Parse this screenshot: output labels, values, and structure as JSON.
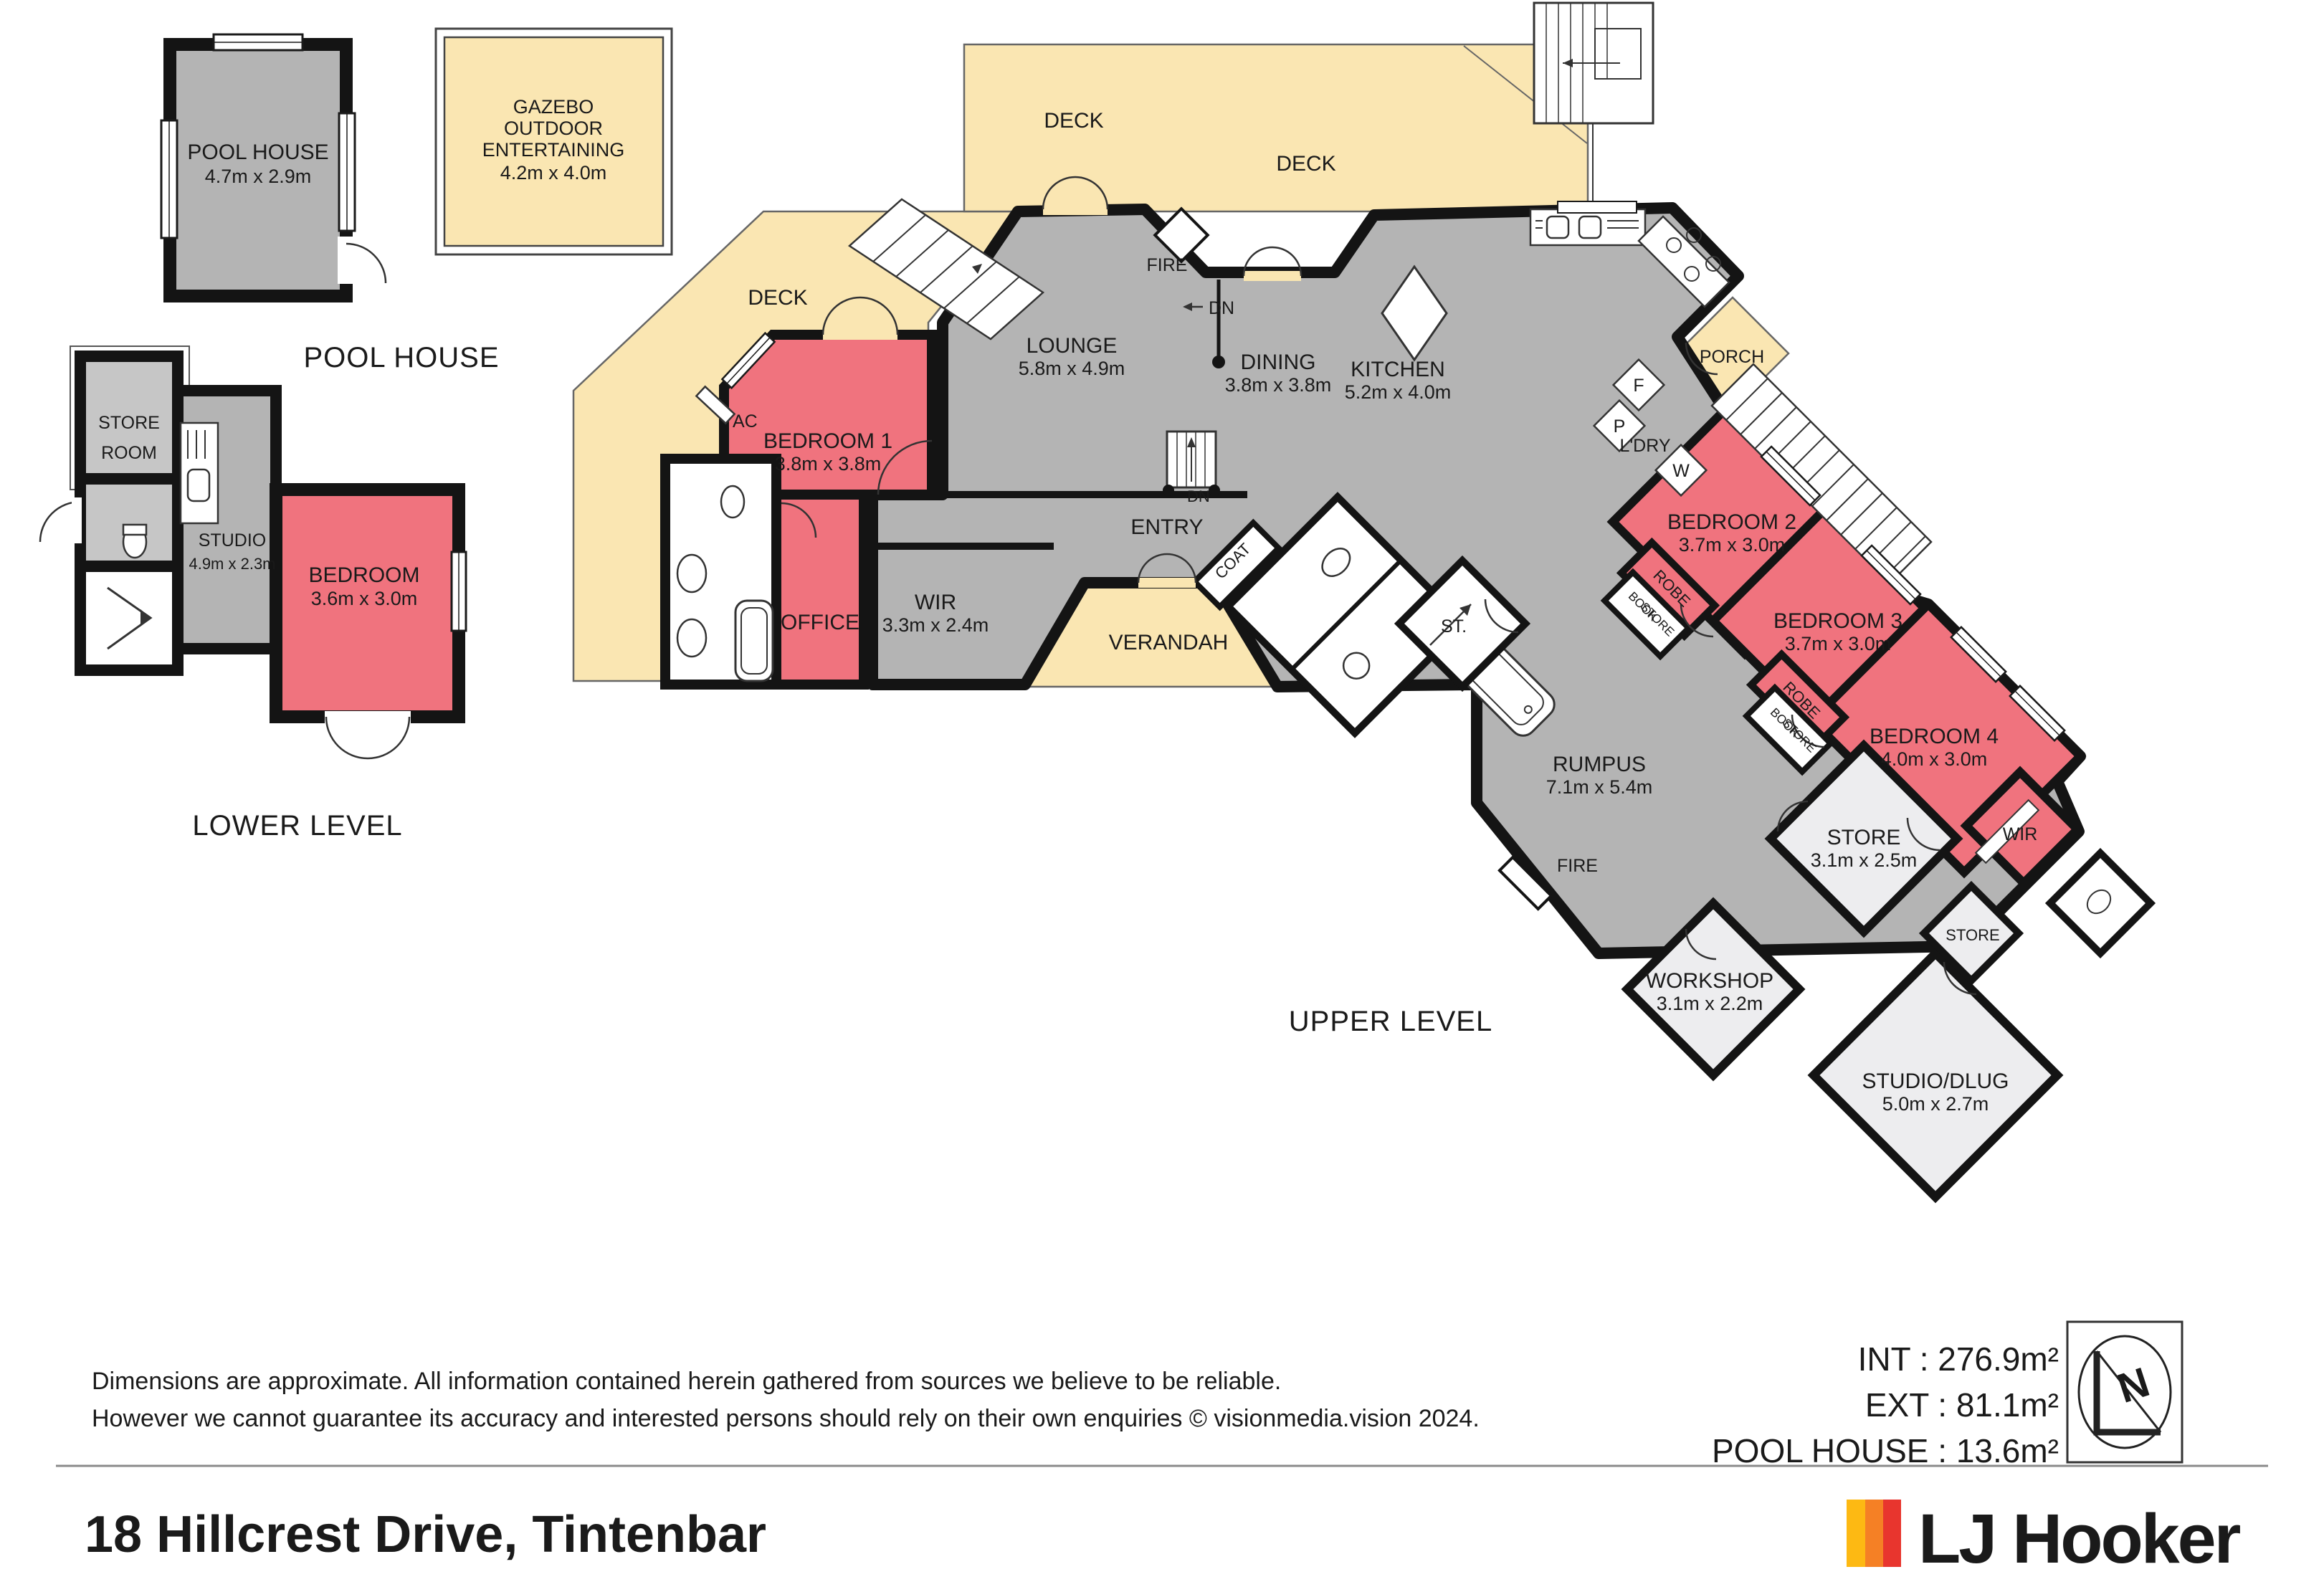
{
  "headings": {
    "pool_house": "POOL HOUSE",
    "lower_level": "LOWER LEVEL",
    "upper_level": "UPPER LEVEL"
  },
  "rooms": {
    "pool_house": {
      "name": "POOL HOUSE",
      "dims": "4.7m x 2.9m"
    },
    "gazebo": {
      "line1": "GAZEBO",
      "line2": "OUTDOOR",
      "line3": "ENTERTAINING",
      "dims": "4.2m x 4.0m"
    },
    "store_room": {
      "line1": "STORE",
      "line2": "ROOM"
    },
    "studio": {
      "name": "STUDIO",
      "dims": "4.9m x 2.3m"
    },
    "bedroom_lower": {
      "name": "BEDROOM",
      "dims": "3.6m x 3.0m"
    },
    "lounge": {
      "name": "LOUNGE",
      "dims": "5.8m x 4.9m"
    },
    "dining": {
      "name": "DINING",
      "dims": "3.8m x 3.8m"
    },
    "kitchen": {
      "name": "KITCHEN",
      "dims": "5.2m x 4.0m"
    },
    "bedroom1": {
      "name": "BEDROOM 1",
      "dims": "3.8m x 3.8m"
    },
    "office": {
      "name": "OFFICE"
    },
    "wir_main": {
      "name": "WIR",
      "dims": "3.3m x 2.4m"
    },
    "bedroom2": {
      "name": "BEDROOM 2",
      "dims": "3.7m x 3.0m"
    },
    "bedroom3": {
      "name": "BEDROOM 3",
      "dims": "3.7m x 3.0m"
    },
    "bedroom4": {
      "name": "BEDROOM 4",
      "dims": "4.0m x 3.0m"
    },
    "rumpus": {
      "name": "RUMPUS",
      "dims": "7.1m x 5.4m"
    },
    "store_big": {
      "name": "STORE",
      "dims": "3.1m x 2.5m"
    },
    "workshop": {
      "name": "WORKSHOP",
      "dims": "3.1m x 2.2m"
    },
    "studio_dlug": {
      "name": "STUDIO/DLUG",
      "dims": "5.0m x 2.7m"
    }
  },
  "labels": {
    "deck": "DECK",
    "verandah": "VERANDAH",
    "entry": "ENTRY",
    "porch": "PORCH",
    "ldry": "L'DRY",
    "fire": "FIRE",
    "dn": "DN",
    "coat": "COAT",
    "st": "ST.",
    "ac": "AC",
    "robe": "ROBE",
    "book": "BOOK",
    "store": "STORE",
    "wir": "WIR",
    "f": "F",
    "p": "P",
    "w": "W"
  },
  "footer": {
    "disclaimer1": "Dimensions are approximate. All information contained herein gathered from sources we believe to be reliable.",
    "disclaimer2": "However we cannot guarantee its accuracy and interested persons should rely on their own enquiries © visionmedia.vision 2024.",
    "areas": {
      "interior": "INT : 276.9m²",
      "exterior": "EXT : 81.1m²",
      "pool_house": "POOL HOUSE :  13.6m²"
    },
    "address": "18 Hillcrest Drive, Tintenbar",
    "brand": "LJ Hooker"
  },
  "compass": {
    "n": "N"
  },
  "colors": {
    "deck_yellow": "#FAE6B2",
    "room_gray": "#B4B4B4",
    "bedroom_pink": "#F0737E",
    "utility_gray": "#EDEDEF",
    "wall_black": "#141414",
    "logo_yellow": "#FDB913",
    "logo_orange": "#F58025",
    "logo_red": "#E8352E"
  }
}
